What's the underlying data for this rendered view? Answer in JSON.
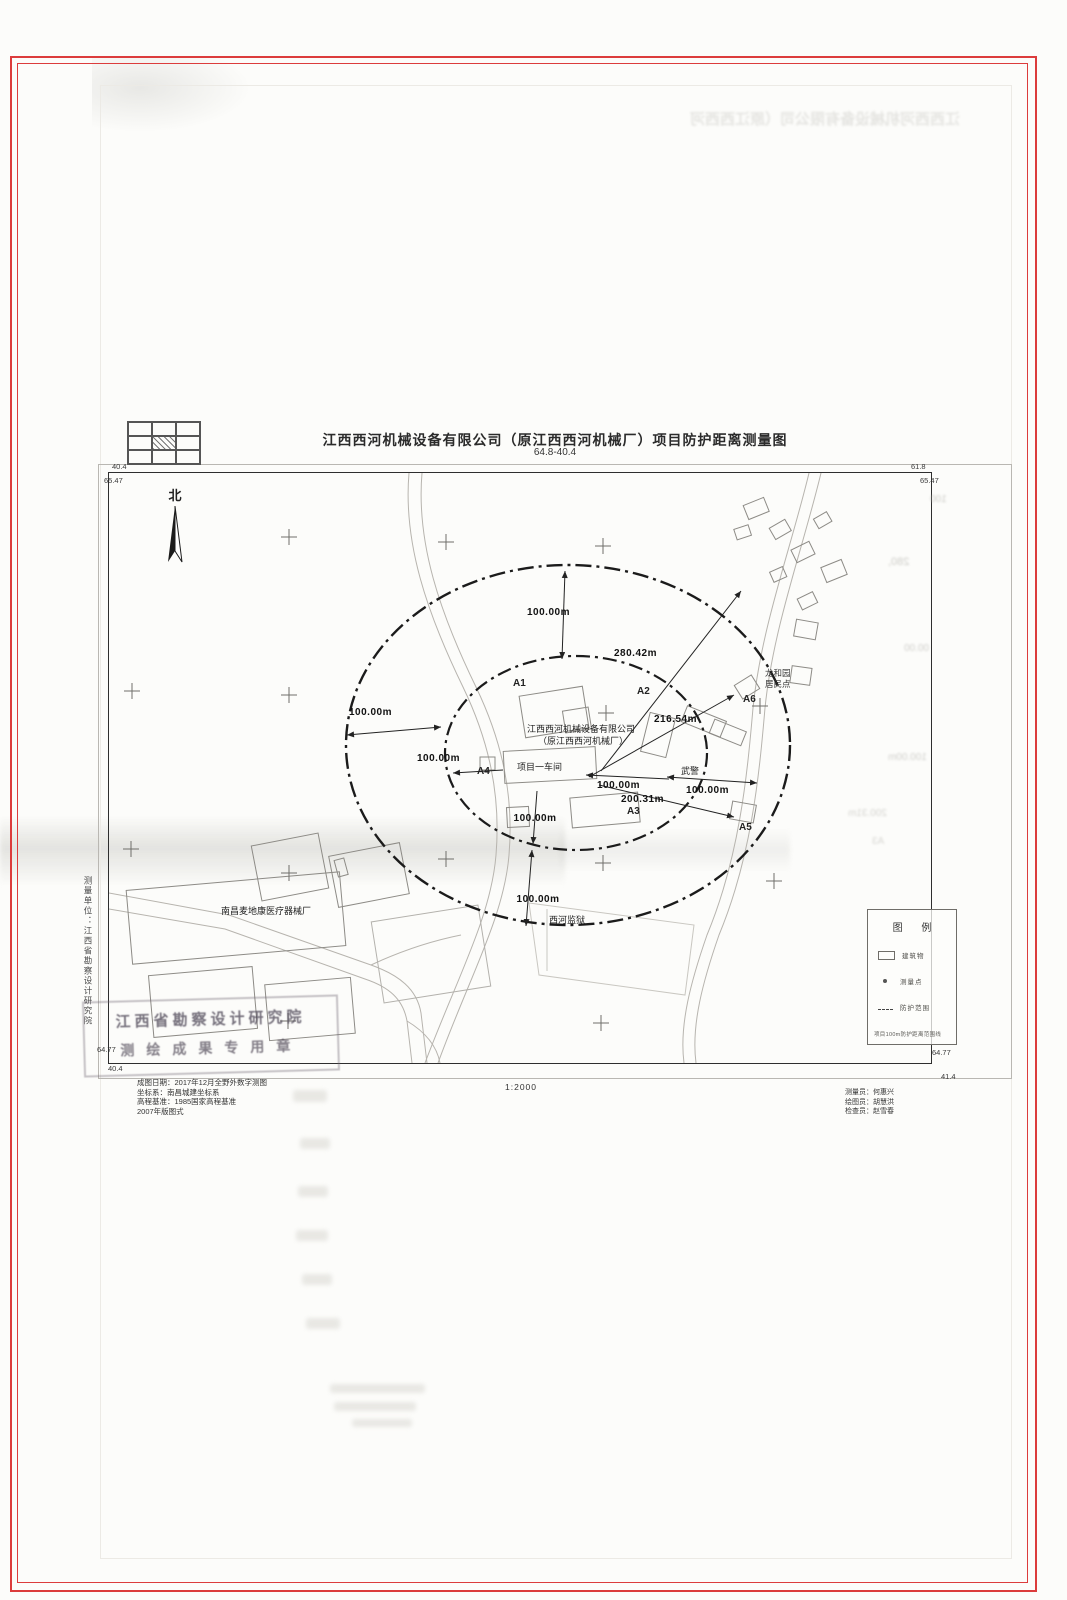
{
  "page": {
    "title": "江西西河机械设备有限公司（原江西西河机械厂）项目防护距离测量图",
    "subtitle": "64.8-40.4",
    "scale": "1:2000"
  },
  "map": {
    "north": "北",
    "corners": {
      "tl_outer": "40.4",
      "tl_inner": "65.47",
      "tr_outer": "61.8",
      "tr_inner": "65.47",
      "bl_inner": "64.77",
      "bl_outer": "40.4",
      "br_inner": "64.77",
      "br_outer": "41.4"
    },
    "site": {
      "company_line1": "江西西河机械设备有限公司",
      "company_line2": "（原江西西河机械厂）",
      "workshop": "项目一车间"
    },
    "places": {
      "prison": "西河监狱",
      "police": "武警",
      "medical_factory": "南昌麦地康医疗器械厂",
      "residential_line1": "龙和园",
      "residential_line2": "居民点"
    },
    "points": {
      "a1": "A1",
      "a2": "A2",
      "a3": "A3",
      "a4": "A4",
      "a5": "A5",
      "a6": "A6"
    },
    "dims": {
      "d100": "100.00m",
      "d280": "280.42m",
      "d216": "216.54m",
      "d200": "200.31m"
    }
  },
  "legend": {
    "title": "图 例",
    "items": [
      {
        "label": "建筑物"
      },
      {
        "label": "测量点"
      },
      {
        "label": "防护范围"
      }
    ],
    "note": "项目100m防护距离范围线"
  },
  "footer": {
    "unit_vertical": "测量单位：江西省勘察设计研究院",
    "stamp_line1": "江西省勘察设计研究院",
    "stamp_line2": "测绘成果专用章",
    "info_lines": [
      "成图日期：2017年12月全野外数字测图",
      "坐标系：南昌城建坐标系",
      "高程基准：1985国家高程基准",
      "2007年版图式"
    ],
    "crew": [
      "测量员：何惠兴",
      "绘图员：胡慧洪",
      "检查员：赵雪春"
    ]
  },
  "ghost": {
    "right": [
      "100",
      "280,",
      "00.00",
      "100.00m",
      "200.31m",
      "A3"
    ]
  }
}
